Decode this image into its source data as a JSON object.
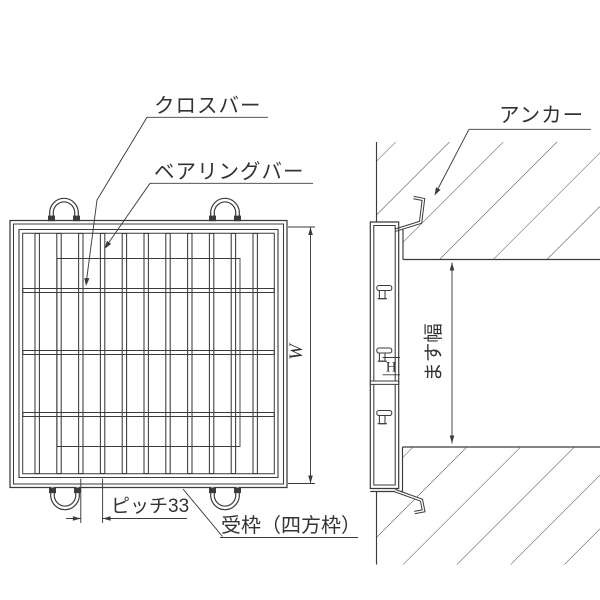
{
  "plan_view": {
    "labels": {
      "cross_bar": "クロスバー",
      "bearing_bar": "ベアリングバー",
      "receiving_frame": "受枠（四方枠）"
    },
    "dimensions": {
      "pitch": "ピッチ33",
      "width": "W"
    }
  },
  "section_view": {
    "labels": {
      "anchor": "アンカー"
    },
    "dimensions": {
      "basin_width": "ます幅",
      "frame_height": "H"
    }
  },
  "colors": {
    "background": "#ffffff",
    "line": "#3b3b3b",
    "hatch": "#4a4a4a",
    "text": "#333333"
  }
}
